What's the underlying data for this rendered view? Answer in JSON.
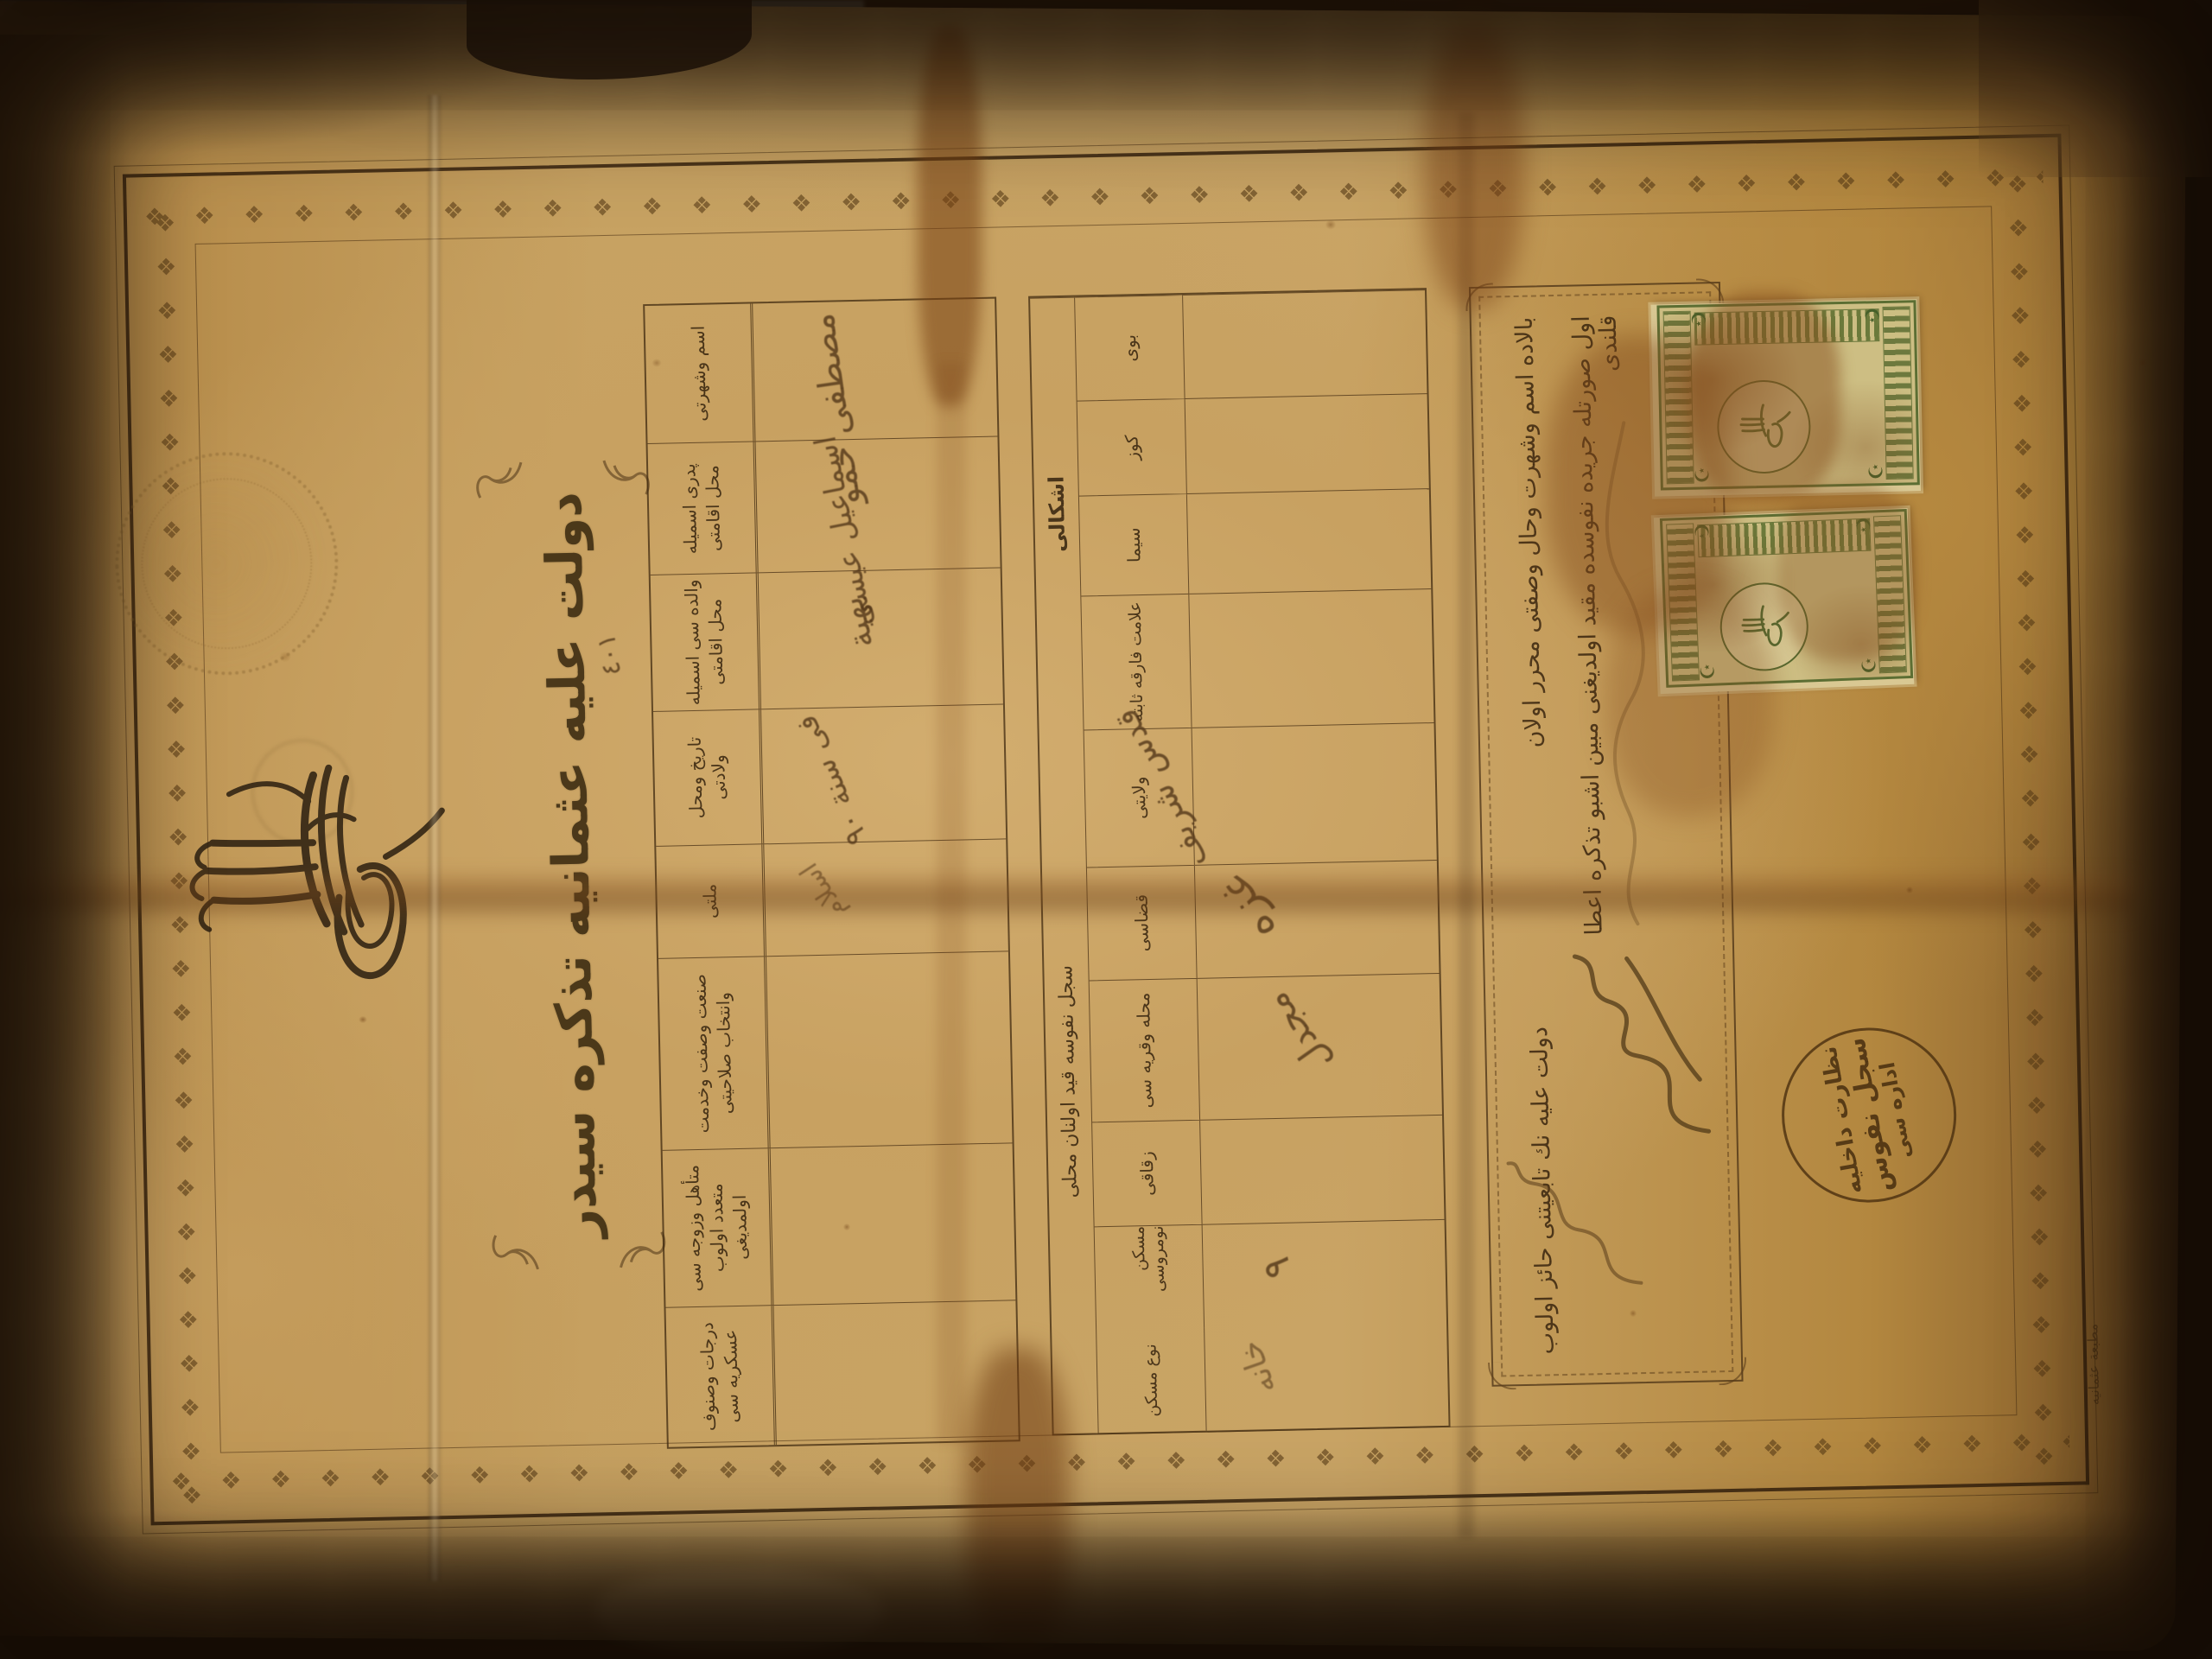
{
  "document": {
    "title": "دولت عليه عثمانيه تذكره سيدر",
    "serial_number": "٤٠١",
    "border_motif": "❖",
    "personal_table": {
      "columns": [
        {
          "label": "اسم وشهرتى",
          "value": "مصطفى حمو"
        },
        {
          "label": "پدرى اسميله محل اقامتى",
          "value": "اسماعيل عيسى"
        },
        {
          "label": "والده سى اسميله محل اقامتى",
          "value": "بهية"
        },
        {
          "label": "تاريخ ومحل ولادتى",
          "value": "فى سنة ٩٠"
        },
        {
          "label": "ملتى",
          "value": "اسلام"
        },
        {
          "label": "صنعت وصفت وخدمت وانتخاب صلاحيتى",
          "value": ""
        },
        {
          "label": "متأهل وزوجه سى متعدد اولوب اولمديغى",
          "value": ""
        },
        {
          "label": "درجات وصنوف عسكريه سى",
          "value": ""
        }
      ]
    },
    "registry_table": {
      "groups": [
        {
          "label": "اشكالى"
        },
        {
          "label": "سجل نفوسه قيد اولنان محلى"
        }
      ],
      "columns": [
        {
          "label": "بوى",
          "value": ""
        },
        {
          "label": "كوز",
          "value": ""
        },
        {
          "label": "سيما",
          "value": ""
        },
        {
          "label": "علامت فارقه ثابته",
          "value": ""
        },
        {
          "label": "ولايتى",
          "value": "قدس شريف"
        },
        {
          "label": "قضاسى",
          "value": "غزه"
        },
        {
          "label": "محله وقريه سى",
          "value": "مجدل"
        },
        {
          "label": "زقاقى",
          "value": ""
        },
        {
          "label": "مسكن نومروسى",
          "value": "٩"
        },
        {
          "label": "نوع مسكن",
          "value": "خانه"
        }
      ]
    },
    "statement": {
      "opening": "بالاده اسم وشهرت وحال وصفتى محرر اولان",
      "closing": "دولت عليه نك تابعيتنى حائز اولوب",
      "second_line": "اول صورتله جريده نفوسده مقيد اولديغنى مبين اشبو تذكره اعطا قلندى"
    },
    "seal_lines": [
      "نظارت داخليه",
      "سجل نفوس",
      "اداره سى"
    ],
    "printer_mark": "مطبعة عثمانيه"
  }
}
